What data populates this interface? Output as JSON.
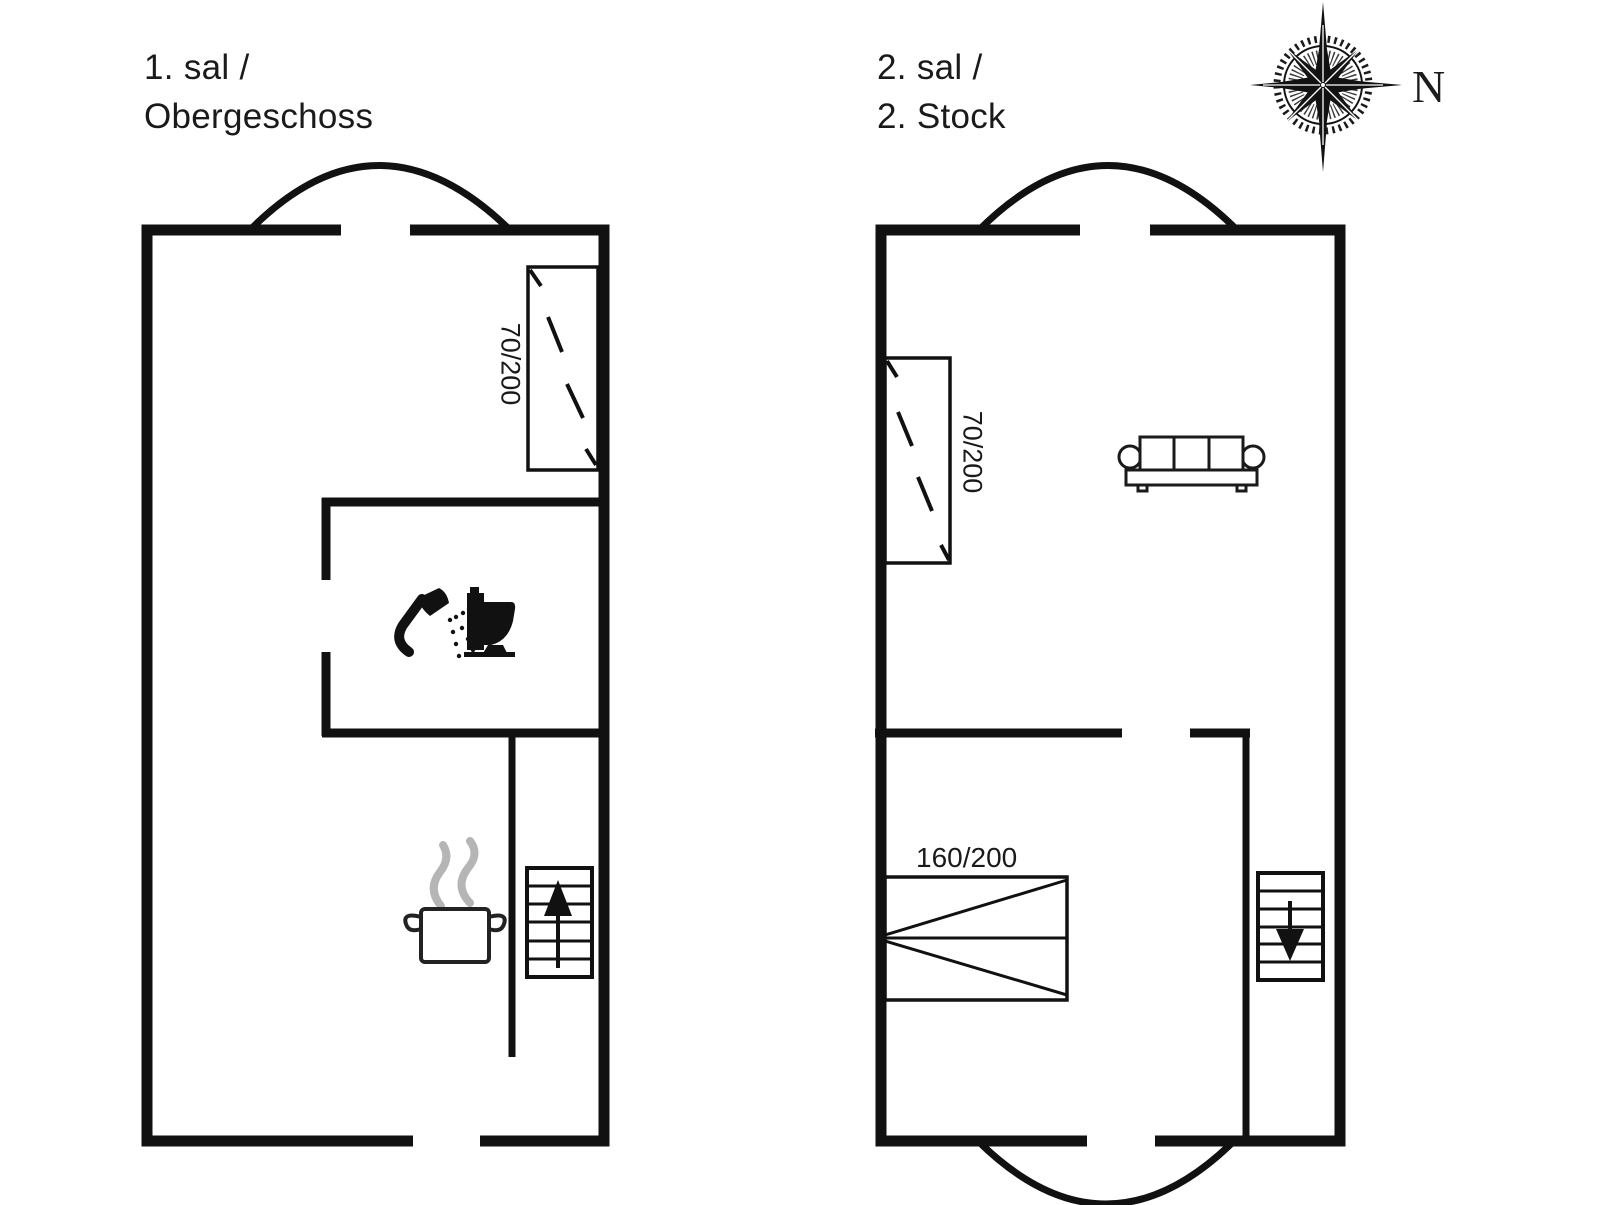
{
  "colors": {
    "ink": "#111111",
    "furniture_ink": "#1a1a1a",
    "steam_gray": "#b5b5b5",
    "background": "#ffffff"
  },
  "floor_left": {
    "title_line1": "1. sal /",
    "title_line2": "Obergeschoss",
    "bed_label": "70/200"
  },
  "floor_right": {
    "title_line1": "2. sal /",
    "title_line2": "2. Stock",
    "bed_small_label": "70/200",
    "bed_large_label": "160/200"
  },
  "compass": {
    "north_label": "N"
  },
  "icons": {
    "floor_left": [
      "entrance-arch",
      "single-bed",
      "shower",
      "toilet",
      "cooking-pot",
      "stairs-up"
    ],
    "floor_right": [
      "entrance-arch",
      "single-bed",
      "sofa",
      "double-bed",
      "stairs-down"
    ],
    "corner": [
      "compass-rose"
    ]
  }
}
